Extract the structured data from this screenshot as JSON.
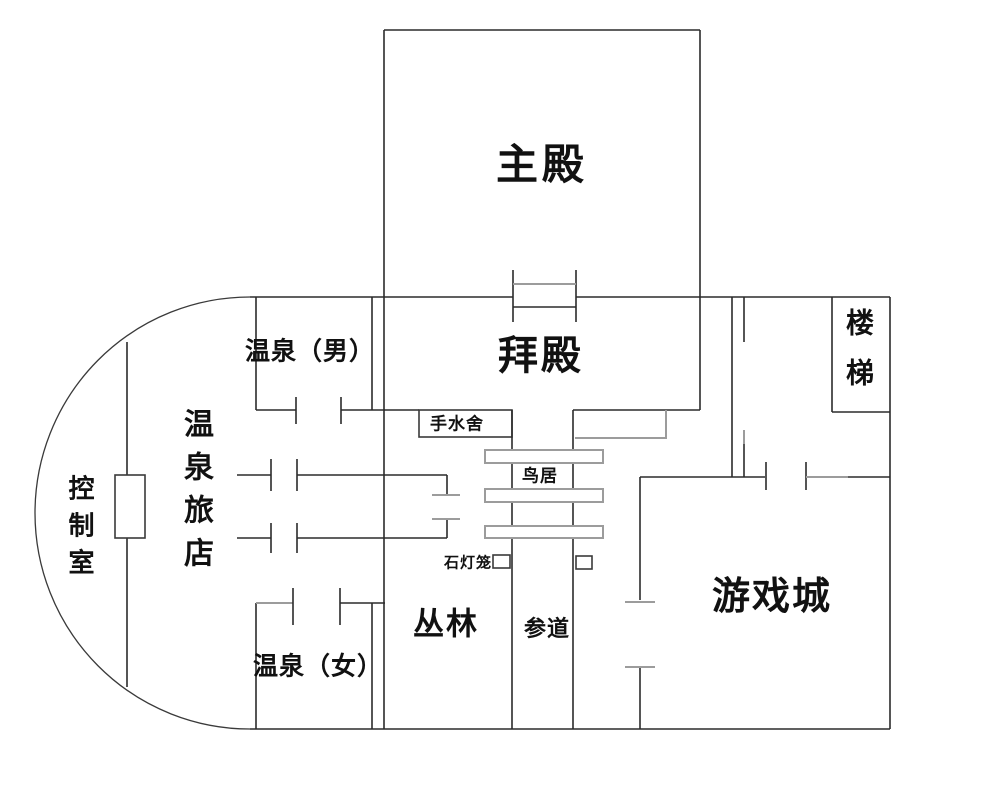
{
  "floorplan": {
    "labels": {
      "main_hall": "主殿",
      "worship_hall": "拜殿",
      "hot_spring_men": "温泉（男）",
      "hot_spring_women": "温泉（女）",
      "hot_spring_inn": "温泉旅店",
      "control_room": "控制室",
      "temizuya": "手水舍",
      "torii": "鸟居",
      "stone_lantern": "石灯笼",
      "jungle": "丛林",
      "approach_path": "参道",
      "game_city": "游戏城",
      "stairs": "楼梯"
    },
    "colors": {
      "wall": "#2b2b2b",
      "wall_light": "#9c9c9c",
      "text": "#111111",
      "background": "#ffffff"
    }
  }
}
